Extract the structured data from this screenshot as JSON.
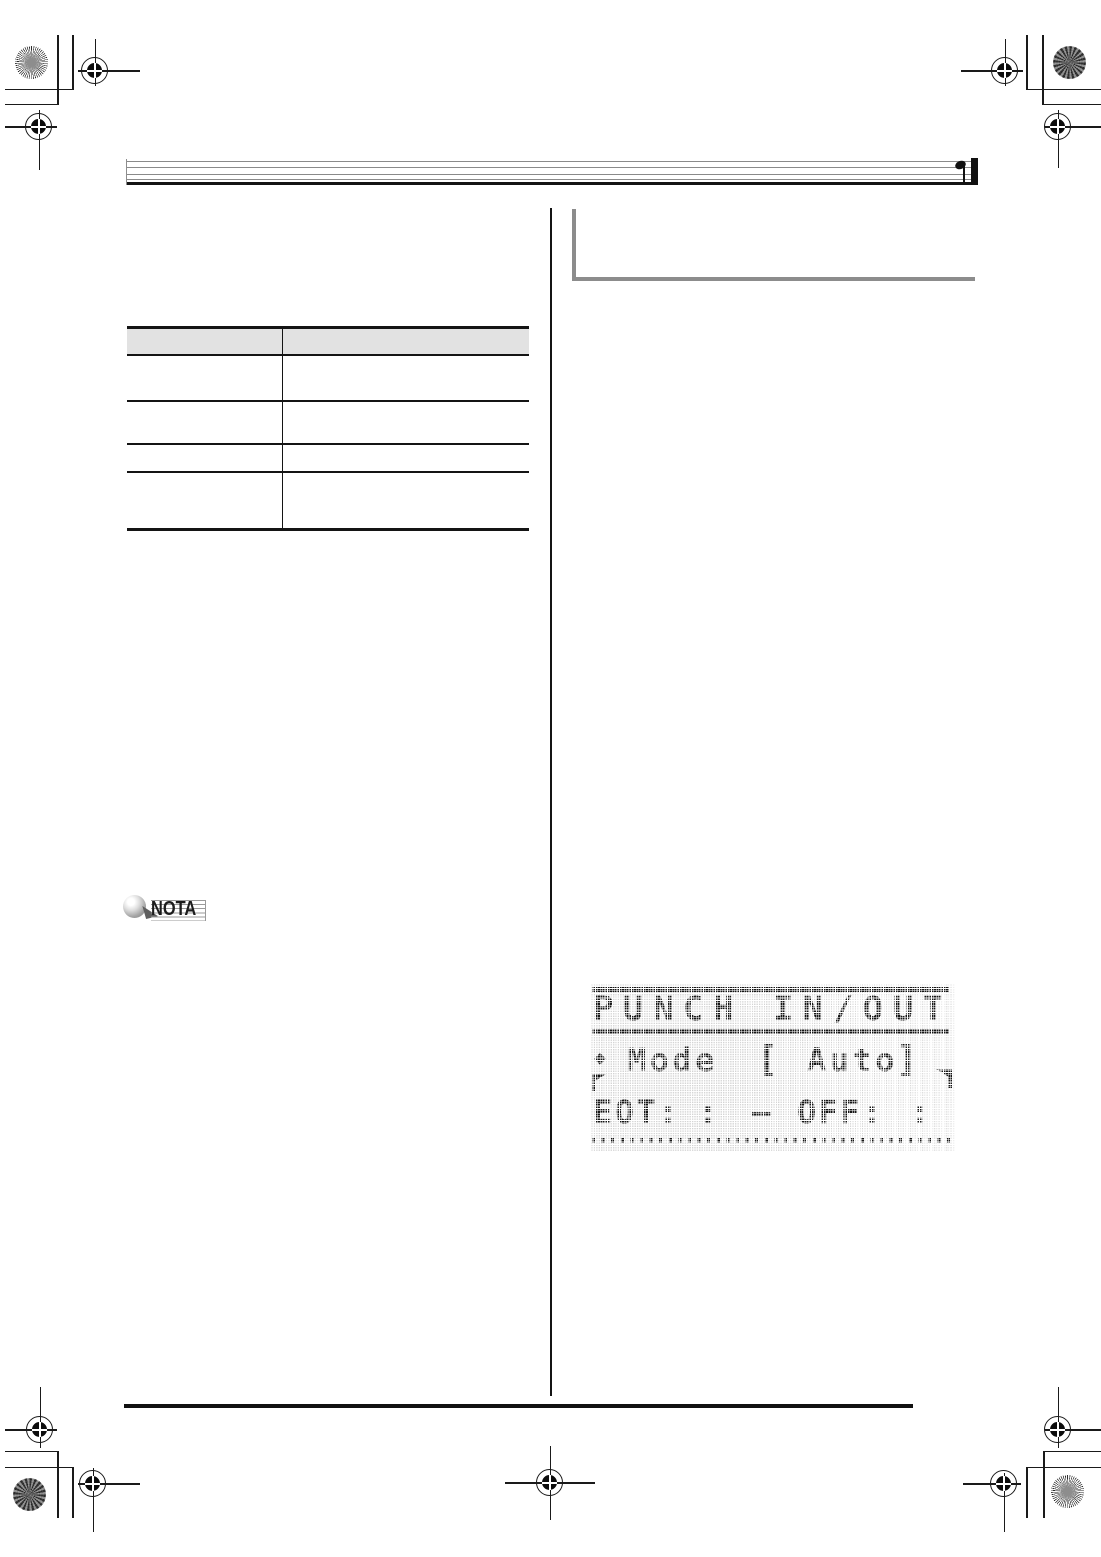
{
  "colors": {
    "table_header_bg": "#e2e2e2",
    "section_bar_gray": "#8c8c8c",
    "staff_line_gray": "#8a8a8a",
    "rule_black": "#141414",
    "lcd_pixel_on": "#161616",
    "lcd_pixel_off": "#d4d4d4"
  },
  "note_badge": {
    "label": "NOTA"
  },
  "table": {
    "header": [
      "",
      ""
    ],
    "rows": [
      [
        "",
        ""
      ],
      [
        "",
        ""
      ],
      [
        "",
        ""
      ],
      [
        "",
        ""
      ]
    ]
  },
  "lcd_display": {
    "title": "PUNCH IN/OUT",
    "mode_line": {
      "bullet": "◆",
      "label": "Mode",
      "bracket_open": "[",
      "value": "Auto",
      "bracket_close": "]"
    },
    "punch_line": {
      "left_label": "EOT:",
      "left_value": ":",
      "separator": "–",
      "right_label": "OFF:",
      "right_value": ":"
    }
  }
}
